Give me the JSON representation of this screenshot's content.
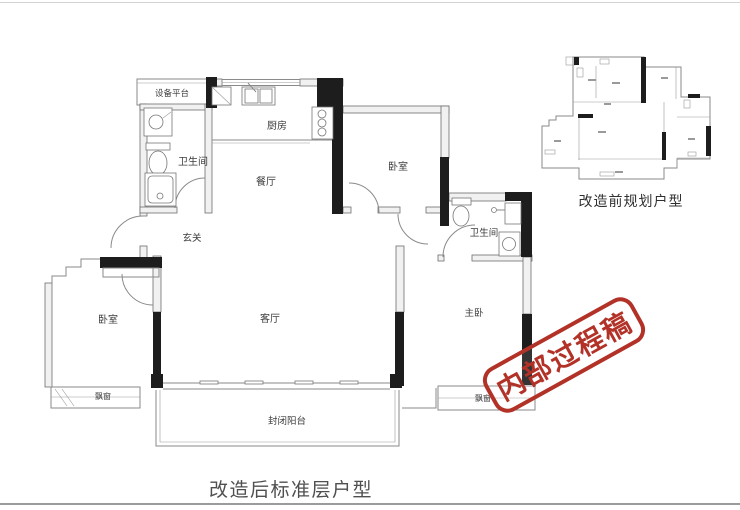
{
  "captions": {
    "main": "改造后标准层户型",
    "mini": "改造前规划户型"
  },
  "stamp": {
    "text": "内部过程稿",
    "color": "#b23228"
  },
  "main_plan": {
    "rooms": {
      "equipment_platform": "设备平台",
      "bathroom_left": "卫生间",
      "kitchen": "厨房",
      "dining_room": "餐厅",
      "hallway": "玄关",
      "bedroom_left": "卧室",
      "bedroom_middle": "卧室",
      "bathroom_right": "卫生间",
      "living_room": "客厅",
      "master_bedroom": "主卧",
      "bay_window_left": "飘窗",
      "bay_window_right": "飘窗",
      "balcony": "封闭阳台"
    }
  },
  "colors": {
    "wall_black": "#1d1d1d",
    "line_gray": "#8a8a8a",
    "label_gray": "#3c3c3c",
    "stamp_red": "#b23228",
    "caption_gray": "#4f4f4f"
  }
}
